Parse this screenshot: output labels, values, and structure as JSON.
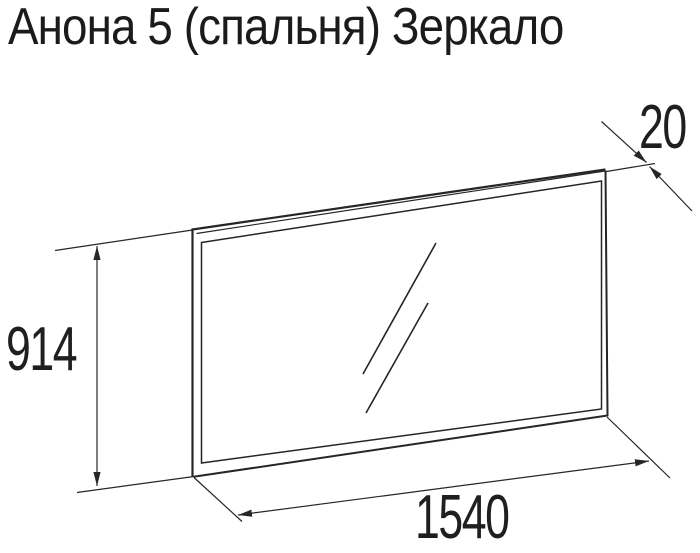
{
  "title": "Анона 5 (спальня) Зеркало",
  "drawing": {
    "type": "furniture technical drawing",
    "object": "mirror panel shown in perspective with glass reflection strokes",
    "dimensions": {
      "height": {
        "value": "914"
      },
      "width": {
        "value": "1540"
      },
      "thickness": {
        "value": "20"
      }
    }
  },
  "colors": {
    "background": "#ffffff",
    "line": "#262626",
    "text": "#1b1b1b"
  }
}
